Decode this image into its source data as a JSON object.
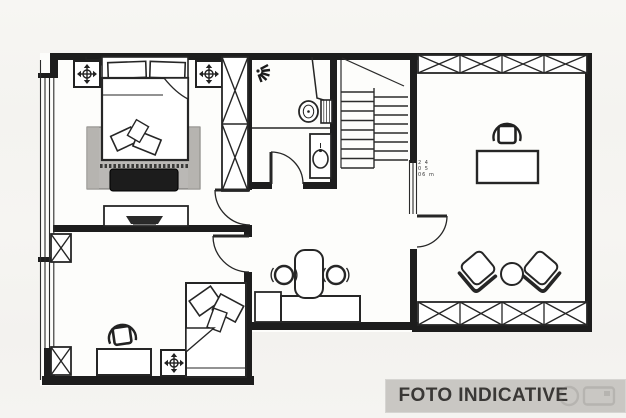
{
  "banner": {
    "label": "FOTO INDICATIVE",
    "bg_color": "#c9c7c3",
    "text_color": "#3a3836"
  },
  "plan": {
    "area_note_lines": [
      "2 4",
      "0 5",
      "06 m"
    ],
    "icons": [
      "ceiling-fixture-icon",
      "shower-head-icon",
      "toilet-icon",
      "sink-icon",
      "watermark-camera-icon"
    ]
  },
  "colors": {
    "ink": "#222222",
    "wall": "#1d1d1d",
    "paper": "#fdfdfb",
    "background": "#f5f4f1",
    "rug": "#cfcecb"
  }
}
